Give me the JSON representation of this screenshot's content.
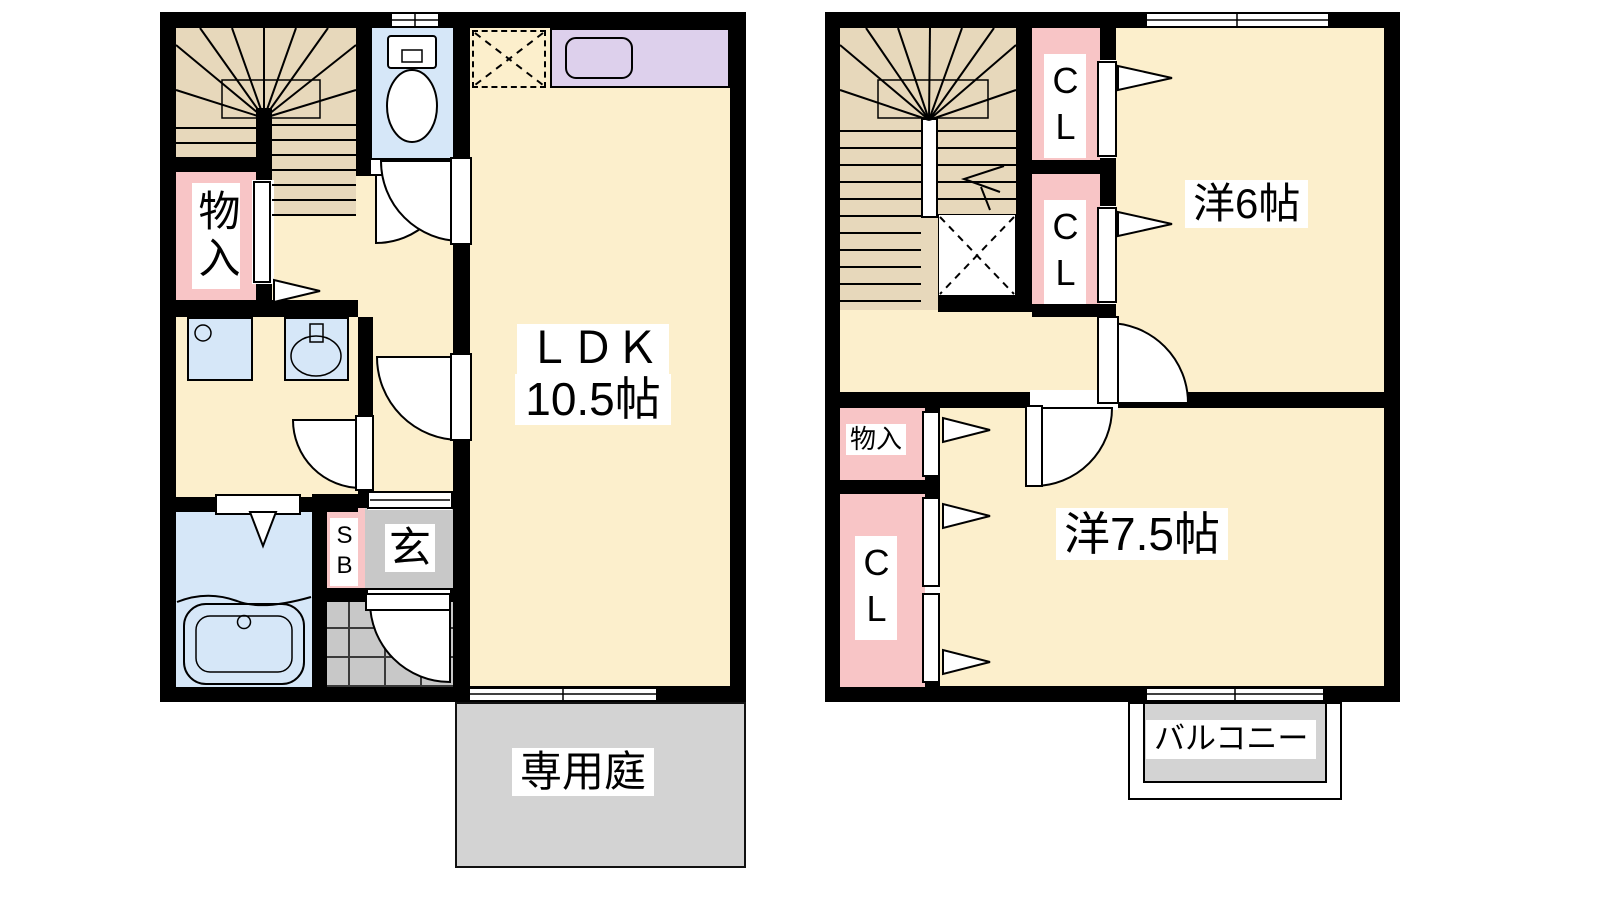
{
  "floor1": {
    "ldk": {
      "name": "ＬＤＫ",
      "size": "10.5帖"
    },
    "storage_label": "物入",
    "shoe_box_label": "SB",
    "entrance_label": "玄",
    "garden_label": "専用庭"
  },
  "floor2": {
    "western6_label": "洋6帖",
    "western75_label": "洋7.5帖",
    "closet_top_label": "CL",
    "closet_middle_label": "CL",
    "closet_bottom_label": "CL",
    "storage_label": "物入",
    "balcony_label": "バルコニー"
  },
  "colors": {
    "wall": "#000000",
    "floor": "#fcefcc",
    "stairs": "#e7d8bb",
    "closet": "#f8c5c6",
    "water": "#d6e7f8",
    "counter": "#ddd0ec",
    "tile": "#c8c8c8",
    "outdoor": "#d3d3d3",
    "label_bg": "#ffffff",
    "line": "#000000"
  }
}
